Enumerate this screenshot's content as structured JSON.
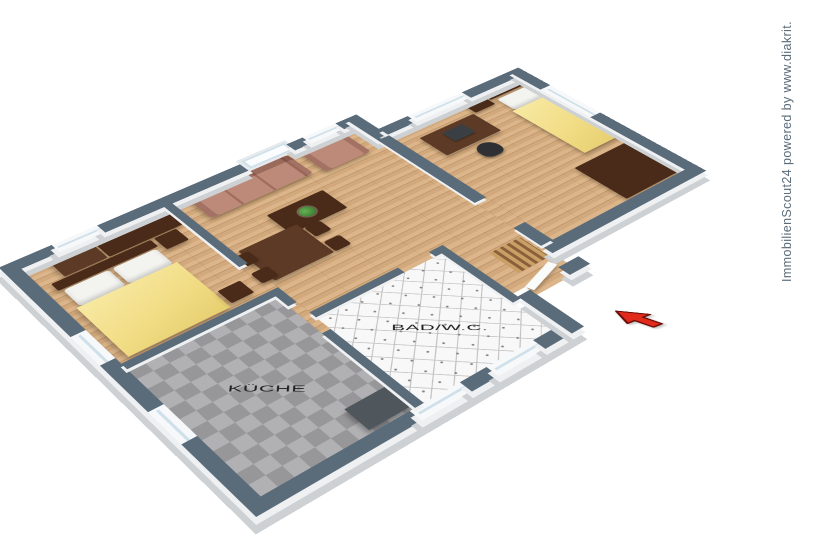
{
  "watermark": {
    "text": "ImmobilienScout24 powered by www.diakrit."
  },
  "rooms": {
    "kitchen": {
      "label": "KÜCHE"
    },
    "bath": {
      "label": "BAD/W.C."
    }
  },
  "entrance": {
    "indicator": "red-arrow"
  },
  "colors": {
    "wallTop": "#5a6b7a",
    "wallFace": "#eef0f2",
    "plinth": "#cdd1d4",
    "wood": "#d2a97c",
    "woodLight": "#dcb68a",
    "woodLine": "#bb9268",
    "kitchenTileA": "#b1b1b3",
    "kitchenTileB": "#97979a",
    "bathBase": "#f8f8f8",
    "bathLine": "#c2c2c2",
    "blanket": "#f2dd86",
    "pillow": "#f3f3f0",
    "darkWood": "#4a2a18",
    "midWood": "#5d3a26",
    "sofa": "#bd8a7a",
    "sofaDark": "#a06c5c",
    "counter": "#4f565c",
    "glass": "#cfe0ea",
    "arrow": "#e02a1c",
    "arrowOutline": "#6b0c06",
    "labelText": "#1c1c1c"
  }
}
